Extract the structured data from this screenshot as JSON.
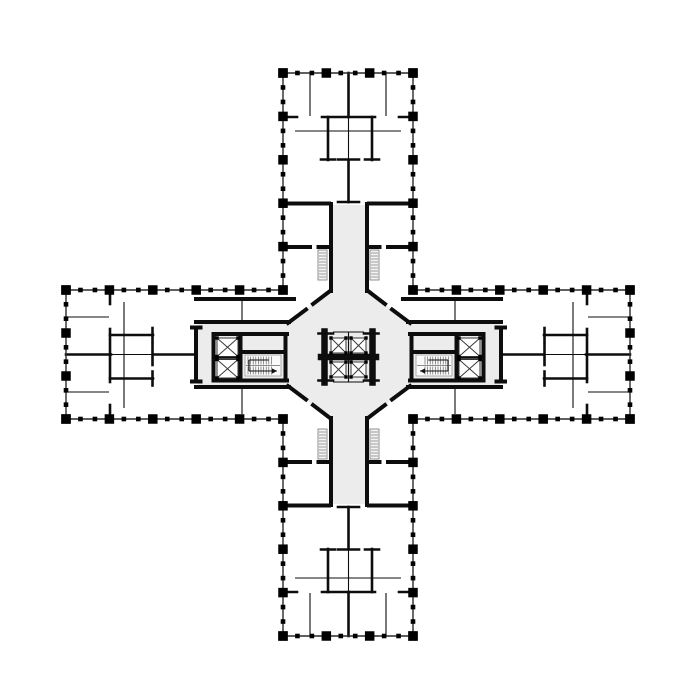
{
  "meta": {
    "kind": "architectural-floor-plan",
    "canvas_width": 700,
    "canvas_height": 700,
    "background": "#ffffff"
  },
  "colors": {
    "wall": "#0d0d0d",
    "perimeter": "#2a2a2a",
    "column": "#000000",
    "circulation_fill": "#ececec",
    "shaft_fill": "#f3f3f3",
    "shaft_line": "#777777",
    "stair_outline": "#999999",
    "stair_tread": "#666666",
    "stair_arrow": "#111111",
    "elevator_line": "#333333"
  },
  "floor_plan": {
    "legend_counts": {
      "elevator_shafts": 8,
      "stairs": 2,
      "vent_shafts": 4
    },
    "fills": {
      "octagon": [
        [
          330,
          291
        ],
        [
          368,
          291
        ],
        [
          410,
          323
        ],
        [
          410,
          386
        ],
        [
          368,
          418
        ],
        [
          330,
          418
        ],
        [
          288,
          386
        ],
        [
          288,
          323
        ]
      ],
      "strips": [
        [
          332.5,
          205,
          33,
          110
        ],
        [
          332.5,
          395,
          33,
          109
        ],
        [
          198,
          324,
          110,
          61
        ],
        [
          390,
          324,
          110,
          61
        ]
      ]
    },
    "walls": {
      "heavy": [
        [
          283,
          203.5,
          329,
          203.5
        ],
        [
          369,
          203.5,
          413,
          203.5
        ],
        [
          331,
          204,
          331,
          291
        ],
        [
          367,
          204,
          367,
          291
        ],
        [
          283,
          247,
          310,
          247
        ],
        [
          318.5,
          247,
          329,
          247
        ],
        [
          369,
          247,
          379.5,
          247
        ],
        [
          388,
          247,
          413,
          247
        ],
        [
          283,
          505.5,
          329,
          505.5
        ],
        [
          369,
          505.5,
          413,
          505.5
        ],
        [
          331,
          418,
          331,
          505
        ],
        [
          367,
          418,
          367,
          505
        ],
        [
          283,
          462,
          310,
          462
        ],
        [
          318.5,
          462,
          329,
          462
        ],
        [
          369,
          462,
          379.5,
          462
        ],
        [
          388,
          462,
          413,
          462
        ],
        [
          196,
          322,
          289,
          322
        ],
        [
          196,
          387,
          289,
          387
        ],
        [
          196,
          328,
          196,
          381
        ],
        [
          192,
          327.5,
          200.5,
          327.5
        ],
        [
          192,
          381.5,
          200.5,
          381.5
        ],
        [
          196,
          299,
          294,
          299
        ],
        [
          213.5,
          334,
          287,
          334
        ],
        [
          213.5,
          380.5,
          287,
          380.5
        ],
        [
          285.5,
          334,
          285.5,
          380.5
        ],
        [
          240.5,
          334,
          240.5,
          380.5
        ],
        [
          213.5,
          334,
          213.5,
          380.5
        ],
        [
          241,
          352,
          285,
          352
        ],
        [
          408,
          322,
          501,
          322
        ],
        [
          408,
          387,
          501,
          387
        ],
        [
          501,
          328,
          501,
          381
        ],
        [
          496.5,
          327.5,
          505,
          327.5
        ],
        [
          496.5,
          381.5,
          505,
          381.5
        ],
        [
          403,
          299,
          501,
          299
        ],
        [
          410,
          334,
          483.5,
          334
        ],
        [
          410,
          380.5,
          483.5,
          380.5
        ],
        [
          411.5,
          334,
          411.5,
          380.5
        ],
        [
          456.5,
          334,
          456.5,
          380.5
        ],
        [
          483.5,
          334,
          483.5,
          380.5
        ],
        [
          412,
          352,
          456,
          352
        ],
        [
          330,
          291,
          313,
          304
        ],
        [
          306,
          309.5,
          288,
          323
        ],
        [
          368,
          291,
          385,
          304
        ],
        [
          392,
          309.5,
          410,
          323
        ],
        [
          330,
          418,
          313,
          405
        ],
        [
          306,
          399.5,
          288,
          386
        ],
        [
          368,
          418,
          385,
          405
        ],
        [
          392,
          399.5,
          410,
          386
        ]
      ],
      "xheavy": [
        [
          324.5,
          331.5,
          324.5,
          382.5
        ],
        [
          372.5,
          331.5,
          372.5,
          382.5
        ],
        [
          321,
          357,
          376,
          357
        ]
      ],
      "medium": [
        [
          318.5,
          333.5,
          333,
          333.5
        ],
        [
          318.5,
          380.5,
          333,
          380.5
        ],
        [
          364,
          333.5,
          378.5,
          333.5
        ],
        [
          364,
          380.5,
          378.5,
          380.5
        ],
        [
          283,
          117,
          297,
          117
        ],
        [
          322,
          117,
          375,
          117
        ],
        [
          399,
          117,
          413,
          117
        ],
        [
          328,
          117,
          328,
          160
        ],
        [
          372,
          117,
          372,
          160
        ],
        [
          321,
          159.5,
          335,
          159.5
        ],
        [
          365,
          159.5,
          379,
          159.5
        ],
        [
          348.5,
          73,
          348.5,
          117
        ],
        [
          338,
          159.5,
          359,
          159.5
        ],
        [
          348.5,
          160,
          348.5,
          202
        ],
        [
          338,
          202,
          359,
          202
        ],
        [
          283,
          592,
          297,
          592
        ],
        [
          322,
          592,
          375,
          592
        ],
        [
          399,
          592,
          413,
          592
        ],
        [
          328,
          549,
          328,
          592
        ],
        [
          372,
          549,
          372,
          592
        ],
        [
          321,
          549.5,
          335,
          549.5
        ],
        [
          365,
          549.5,
          379,
          549.5
        ],
        [
          348.5,
          592,
          348.5,
          636
        ],
        [
          338,
          549.5,
          359,
          549.5
        ],
        [
          348.5,
          507,
          348.5,
          549
        ],
        [
          338,
          507,
          359,
          507
        ],
        [
          110,
          290,
          110,
          304
        ],
        [
          110,
          329,
          110,
          382
        ],
        [
          110,
          405,
          110,
          419
        ],
        [
          110,
          335,
          153,
          335
        ],
        [
          110,
          378.5,
          153,
          378.5
        ],
        [
          152.5,
          328,
          152.5,
          342
        ],
        [
          152.5,
          344,
          152.5,
          365
        ],
        [
          152.5,
          371.5,
          152.5,
          385.5
        ],
        [
          66,
          354.5,
          111,
          354.5
        ],
        [
          153,
          354.5,
          196,
          354.5
        ],
        [
          214,
          357.5,
          240,
          357.5
        ],
        [
          587,
          290,
          587,
          304
        ],
        [
          587,
          329,
          587,
          382
        ],
        [
          587,
          405,
          587,
          419
        ],
        [
          544,
          335,
          587,
          335
        ],
        [
          544,
          378.5,
          587,
          378.5
        ],
        [
          544.5,
          328,
          544.5,
          342
        ],
        [
          544.5,
          344,
          544.5,
          365
        ],
        [
          544.5,
          371.5,
          544.5,
          385.5
        ],
        [
          586,
          354.5,
          630,
          354.5
        ],
        [
          501,
          354.5,
          544,
          354.5
        ],
        [
          457,
          357.5,
          483,
          357.5
        ]
      ],
      "thin": [
        [
          333,
          332,
          364,
          332
        ],
        [
          333,
          382,
          364,
          382
        ],
        [
          348.5,
          332,
          348.5,
          354
        ],
        [
          348.5,
          360,
          348.5,
          382
        ],
        [
          310,
          73,
          310,
          116
        ],
        [
          386,
          73,
          386,
          116
        ],
        [
          348.5,
          117,
          348.5,
          160
        ],
        [
          295,
          131,
          401,
          131
        ],
        [
          310,
          593,
          310,
          636
        ],
        [
          386,
          593,
          386,
          636
        ],
        [
          348.5,
          549,
          348.5,
          592
        ],
        [
          295,
          578,
          401,
          578
        ],
        [
          66,
          317,
          109,
          317
        ],
        [
          66,
          392,
          109,
          392
        ],
        [
          124,
          302,
          124,
          408
        ],
        [
          111,
          354.5,
          152,
          354.5
        ],
        [
          242,
          299,
          242,
          322
        ],
        [
          242,
          387,
          242,
          414
        ],
        [
          588,
          317,
          630,
          317
        ],
        [
          588,
          392,
          630,
          392
        ],
        [
          573,
          302,
          573,
          408
        ],
        [
          545,
          354.5,
          586,
          354.5
        ],
        [
          455,
          299,
          455,
          322
        ],
        [
          455,
          387,
          455,
          414
        ]
      ]
    },
    "perimeter_runs": [
      {
        "a": [
          283,
          73
        ],
        "b": [
          413,
          73
        ],
        "n": 4
      },
      {
        "a": [
          283,
          73
        ],
        "b": [
          283,
          290
        ],
        "n": 6
      },
      {
        "a": [
          413,
          73
        ],
        "b": [
          413,
          290
        ],
        "n": 6
      },
      {
        "a": [
          283,
          636
        ],
        "b": [
          413,
          636
        ],
        "n": 4
      },
      {
        "a": [
          283,
          419
        ],
        "b": [
          283,
          636
        ],
        "n": 6
      },
      {
        "a": [
          413,
          419
        ],
        "b": [
          413,
          636
        ],
        "n": 6
      },
      {
        "a": [
          66,
          290
        ],
        "b": [
          283,
          290
        ],
        "n": 6
      },
      {
        "a": [
          66,
          419
        ],
        "b": [
          283,
          419
        ],
        "n": 6
      },
      {
        "a": [
          66,
          290
        ],
        "b": [
          66,
          419
        ],
        "n": 4
      },
      {
        "a": [
          413,
          290
        ],
        "b": [
          630,
          290
        ],
        "n": 6
      },
      {
        "a": [
          413,
          419
        ],
        "b": [
          630,
          419
        ],
        "n": 6
      },
      {
        "a": [
          630,
          290
        ],
        "b": [
          630,
          419
        ],
        "n": 4
      }
    ],
    "elevators": [
      [
        331,
        338,
        15,
        15
      ],
      [
        351,
        338,
        15,
        15
      ],
      [
        331,
        362,
        15,
        15
      ],
      [
        351,
        362,
        15,
        15
      ],
      [
        217,
        338,
        21,
        18.5
      ],
      [
        217,
        359.5,
        21,
        18.5
      ],
      [
        459,
        338,
        21,
        18.5
      ],
      [
        459,
        359.5,
        21,
        18.5
      ]
    ],
    "stairs": [
      {
        "x": 245,
        "y": 355,
        "w": 36,
        "h": 21,
        "dir": 1
      },
      {
        "x": 416,
        "y": 355,
        "w": 36,
        "h": 21,
        "dir": -1
      }
    ],
    "vent_shafts": [
      [
        318,
        250,
        9,
        30
      ],
      [
        370,
        250,
        9,
        30
      ],
      [
        318,
        429,
        9,
        30
      ],
      [
        370,
        429,
        9,
        30
      ]
    ]
  }
}
